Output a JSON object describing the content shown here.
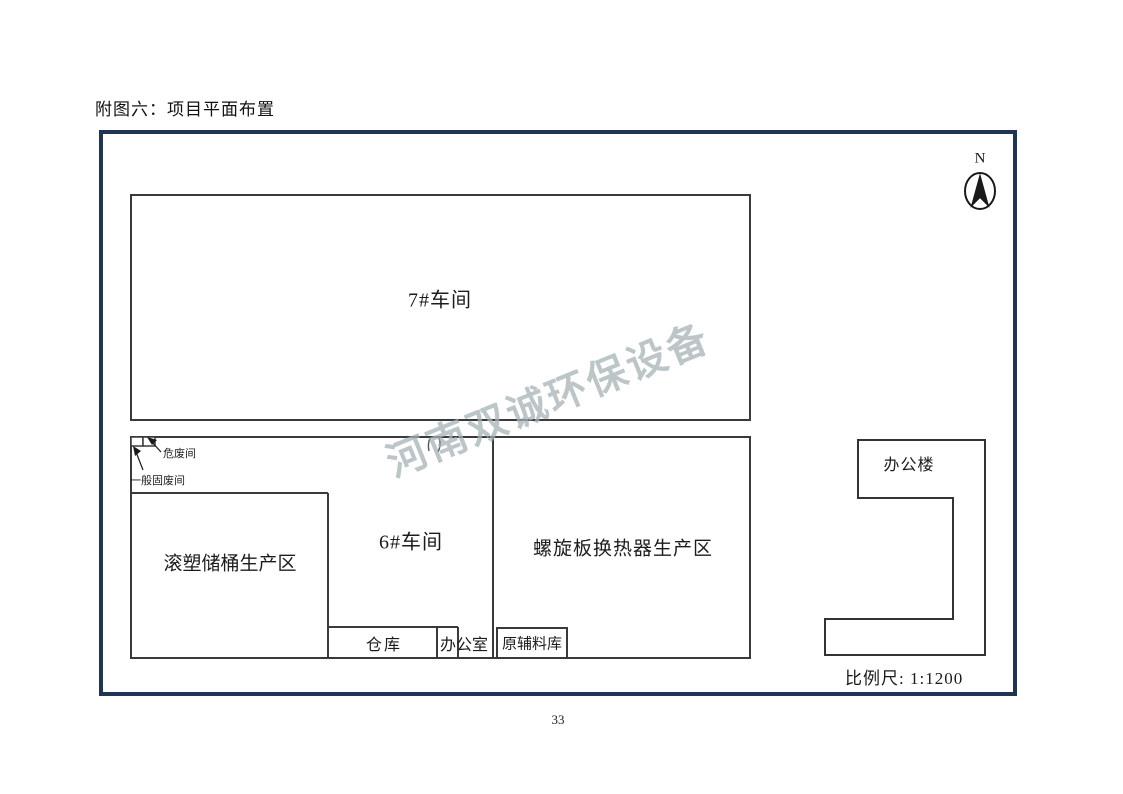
{
  "page": {
    "title": "附图六：项目平面布置",
    "page_number": "33"
  },
  "diagram": {
    "north_label": "N",
    "scale_label": "比例尺: 1:1200",
    "watermark": "河南双诚环保设备",
    "labels": {
      "workshop7": "7#车间",
      "workshop6": "6#车间",
      "rotomolding_area": "滚塑储桶生产区",
      "spiral_area": "螺旋板换热器生产区",
      "warehouse": "仓库",
      "office_room": "办公室",
      "raw_material_store": "原辅料库",
      "office_building": "办公楼",
      "hazardous_waste_room": "危废间",
      "general_waste_room": "一般固废间"
    },
    "colors": {
      "frame": "#1f3555",
      "line": "#3a3a3a",
      "watermark": "#b7c2c4"
    }
  }
}
